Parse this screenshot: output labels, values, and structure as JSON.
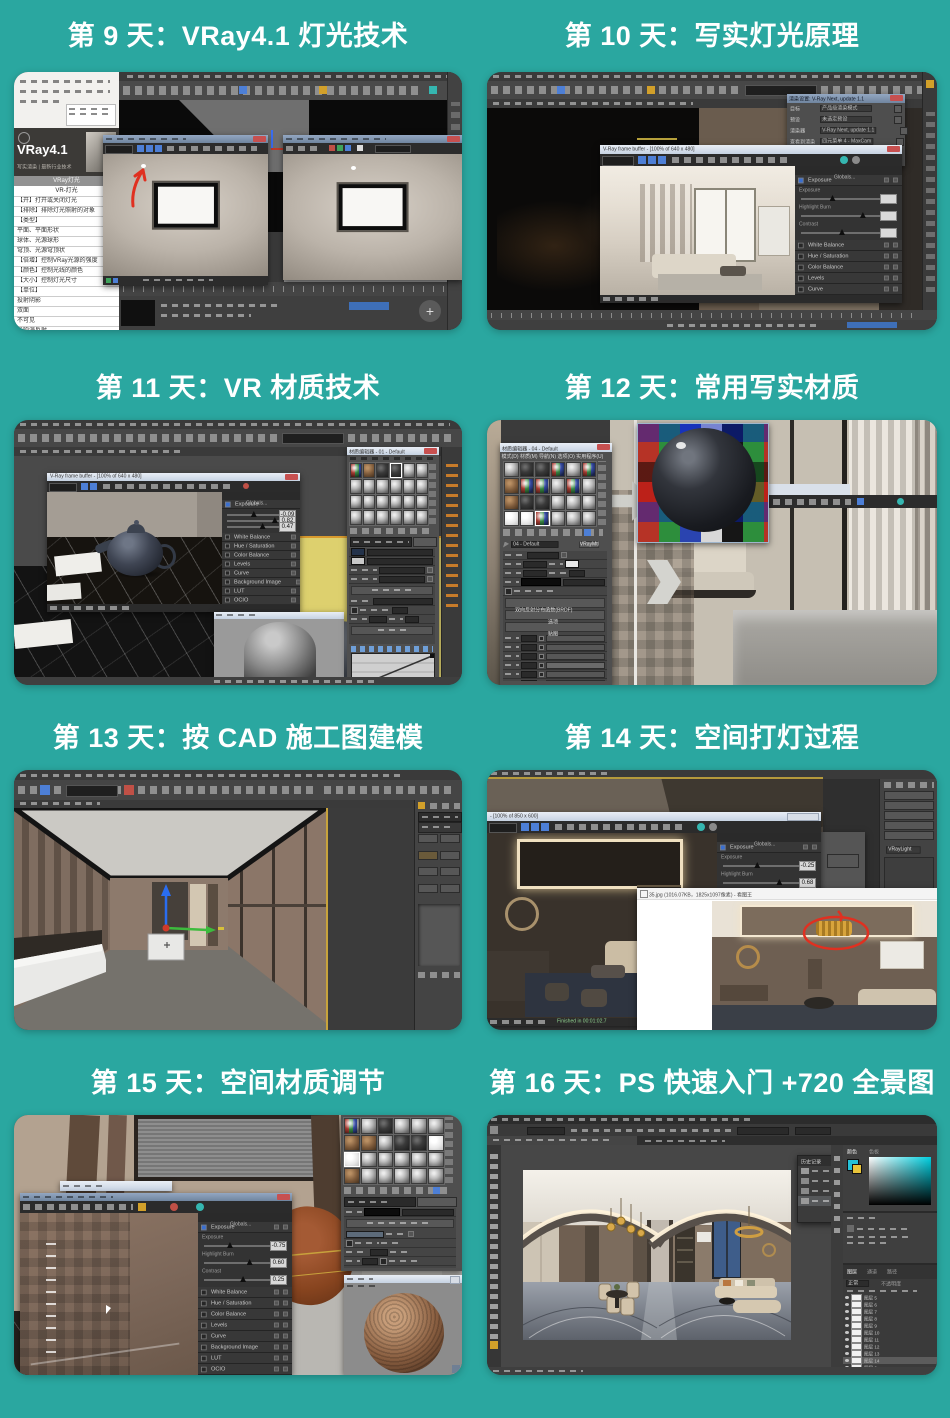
{
  "page": {
    "background": "#2aa7a0",
    "title_color": "#ffffff",
    "annotation_red": "#e03020"
  },
  "titles": [
    {
      "id": "day9",
      "label": "第 9 天：VRay4.1 灯光技术"
    },
    {
      "id": "day10",
      "label": "第 10 天：写实灯光原理"
    },
    {
      "id": "day11",
      "label": "第 11 天：VR 材质技术"
    },
    {
      "id": "day12",
      "label": "第 12 天：常用写实材质"
    },
    {
      "id": "day13",
      "label": "第 13 天：按 CAD 施工图建模"
    },
    {
      "id": "day14",
      "label": "第 14 天：空间打灯过程"
    },
    {
      "id": "day15",
      "label": "第 15 天：空间材质调节"
    },
    {
      "id": "day16",
      "label": "第 16 天：PS 快速入门 +720 全景图"
    }
  ],
  "vfb": {
    "header": "Globals...",
    "exposure": "Exposure",
    "slider_labels": [
      "Exposure",
      "Highlight Burn",
      "Contrast"
    ],
    "corrections": [
      "White Balance",
      "Hue / Saturation",
      "Color Balance",
      "Levels",
      "Curve",
      "Background Image",
      "LUT",
      "OCIO",
      "ICC"
    ]
  },
  "card9": {
    "brand": "VRay4.1",
    "brand_sub": "写实渲染 | 最新行业技术",
    "list_header": "VRay灯光",
    "list_title": "VR-灯光",
    "list": [
      "【开】打开或关闭灯光",
      "【排除】排除灯光照射的对象",
      "【类型】",
      "平面、平面形状",
      "球体、光源球形",
      "穹顶、光源穹顶状",
      "【倍增】控制VRay光源的强度",
      "【颜色】控制光线的颜色",
      "【大小】控制灯光尺寸",
      "【单位】",
      "投射阴影",
      "双面",
      "不可见",
      "影响漫反射",
      "影响高光反射",
      "影响反射"
    ]
  },
  "card10": {
    "vfb_title": "V-Ray frame buffer - [100% of 640 x 480]",
    "rs_title": "渲染设置: V-Ray Next, update 1.1",
    "rs_rows": [
      {
        "label": "目标",
        "value": "产品级渲染模式"
      },
      {
        "label": "预设",
        "value": "未选定预设"
      },
      {
        "label": "渲染器",
        "value": "V-Ray Next, update 1.1"
      },
      {
        "label": "查看到渲染",
        "value": "四元菜单 4 - MaxCam"
      }
    ],
    "rs_render_button": "渲染"
  },
  "card11": {
    "vfb_title": "V-Ray frame buffer - [100% of 640 x 480]",
    "me_title": "材质编辑器 - 01 - Default",
    "exposure_values": [
      "-0.09",
      "0.82",
      "0.47"
    ]
  },
  "card12": {
    "me_title": "材质编辑器 - 04 - Default",
    "me_menu": "模式(D) 材质(M) 导航(N) 选项(O) 实用程序(U)",
    "mtl_name": "04 - Default",
    "mtl_type": "VRayMtl",
    "rollouts": [
      "双向反射分布函数(BRDF)",
      "选项",
      "贴图"
    ]
  },
  "card14": {
    "vfb_title": "- [100% of 850 x 600]",
    "exposure_values": [
      "-0.25",
      "0.68",
      "0.36"
    ],
    "white_balance": "White Balance",
    "finished": "Finished in 00:01:02.7",
    "viewer_title": "35.jpg (1016.07KB，1825x1097像素) - 看图王",
    "vraylight": "VRayLight"
  },
  "card15": {
    "exposure_values": [
      "-0.75",
      "0.60",
      "0.25"
    ]
  },
  "card16": {
    "color_tabs": [
      "颜色",
      "色板"
    ],
    "history_title": "历史记录",
    "layers_tabs": [
      "图层",
      "通道",
      "路径"
    ],
    "blend_mode": "正常",
    "opacity_label": "不透明度",
    "layers": [
      "图层 5",
      "图层 6",
      "图层 7",
      "图层 8",
      "图层 9",
      "图层 10",
      "图层 11",
      "图层 12",
      "图层 13",
      "图层 14",
      "图层 2",
      "图层 3"
    ]
  }
}
